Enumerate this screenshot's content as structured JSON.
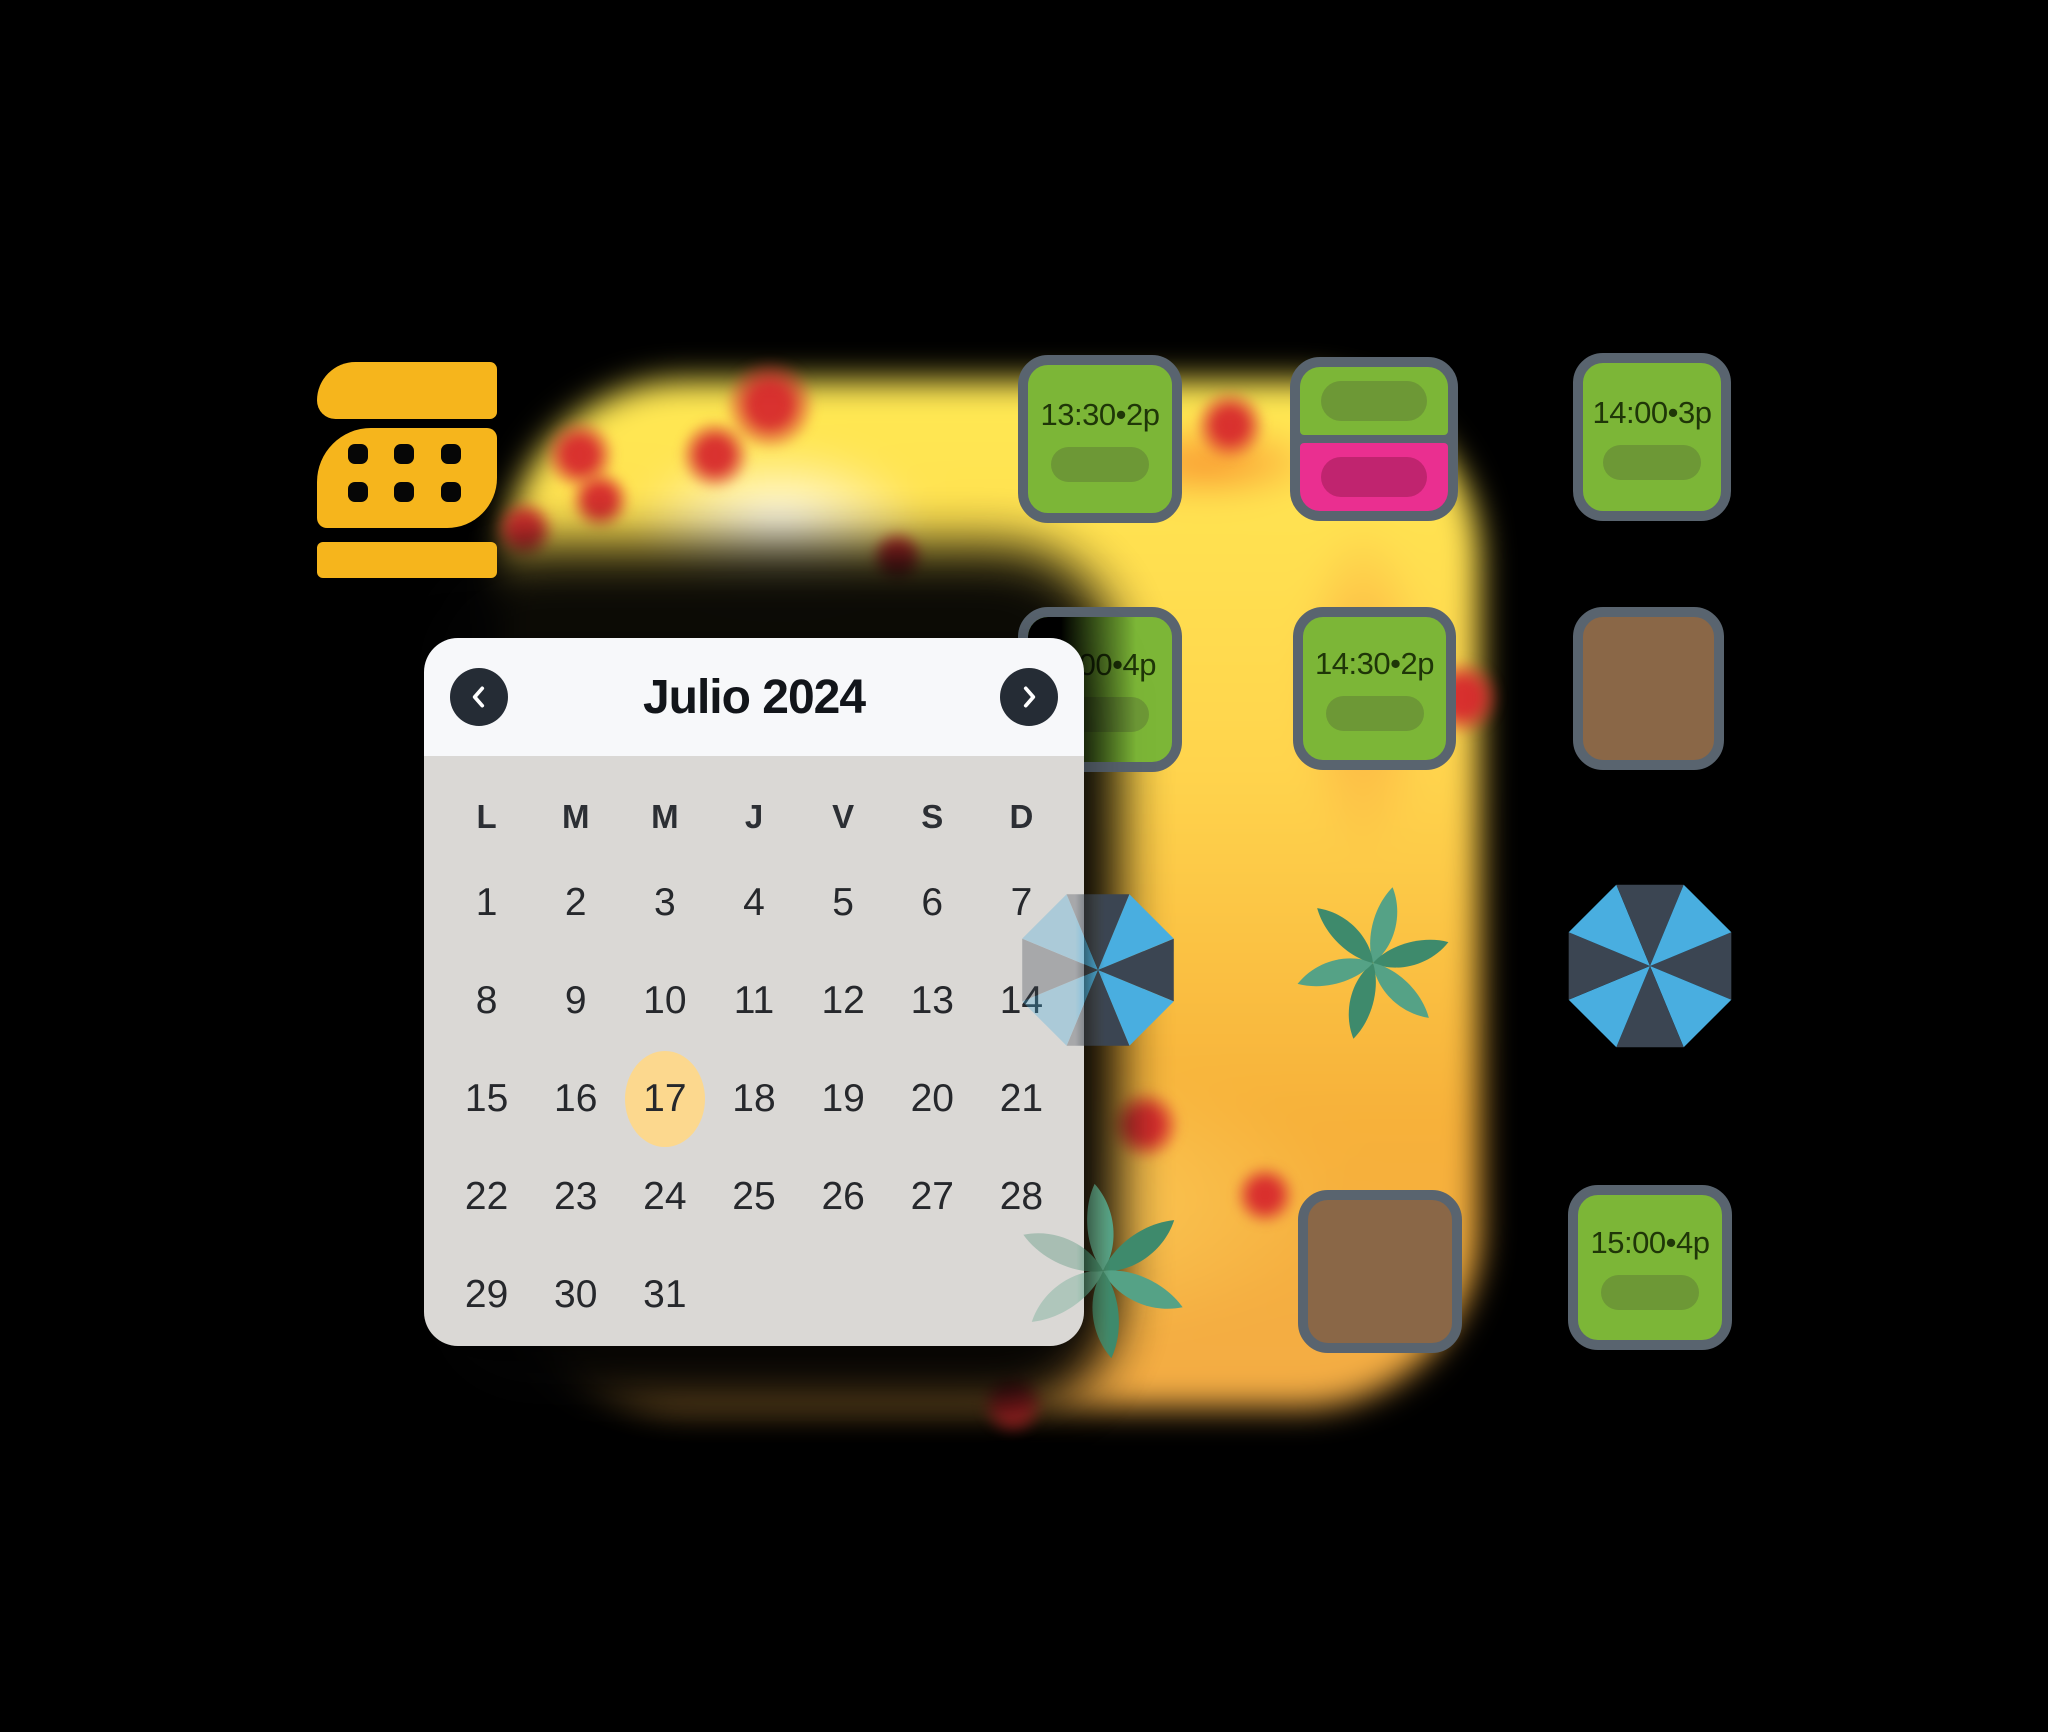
{
  "colors": {
    "background": "#000000",
    "logo_yellow": "#f6b51c",
    "table_green": "#7cb637",
    "table_green_pill": "#6d9836",
    "table_border_slate": "#59646f",
    "table_pink": "#ea2f90",
    "table_pink_pill": "#c0246f",
    "table_brown": "#8a6747",
    "umbrella_blue": "#49aee0",
    "umbrella_dark": "#3b4552",
    "plant_light": "#55a286",
    "plant_dark": "#3e8a6c",
    "heatmap_yellow": "#ffe953",
    "heatmap_orange": "#f8822a",
    "heatmap_red": "#d7282d",
    "selected_day_highlight": "#fcd88e",
    "calendar_header_bg": "#f7f8fa",
    "calendar_body_bg": "#dad8d5",
    "chevron_circle": "#252c35"
  },
  "calendar": {
    "title": "Julio 2024",
    "selected_day": "17",
    "day_headers": [
      "L",
      "M",
      "M",
      "J",
      "V",
      "S",
      "D"
    ],
    "cells": [
      "1",
      "2",
      "3",
      "4",
      "5",
      "6",
      "7",
      "8",
      "9",
      "10",
      "11",
      "12",
      "13",
      "14",
      "15",
      "16",
      "17",
      "18",
      "19",
      "20",
      "21",
      "22",
      "23",
      "24",
      "25",
      "26",
      "27",
      "28",
      "29",
      "30",
      "31",
      "",
      "",
      "",
      ""
    ]
  },
  "tables": {
    "t1": {
      "label": "13:30•2p"
    },
    "t3": {
      "label": "14:00•3p"
    },
    "t4": {
      "label": "00•4p"
    },
    "t5": {
      "label": "14:30•2p"
    },
    "t8": {
      "label": "15:00•4p"
    }
  }
}
